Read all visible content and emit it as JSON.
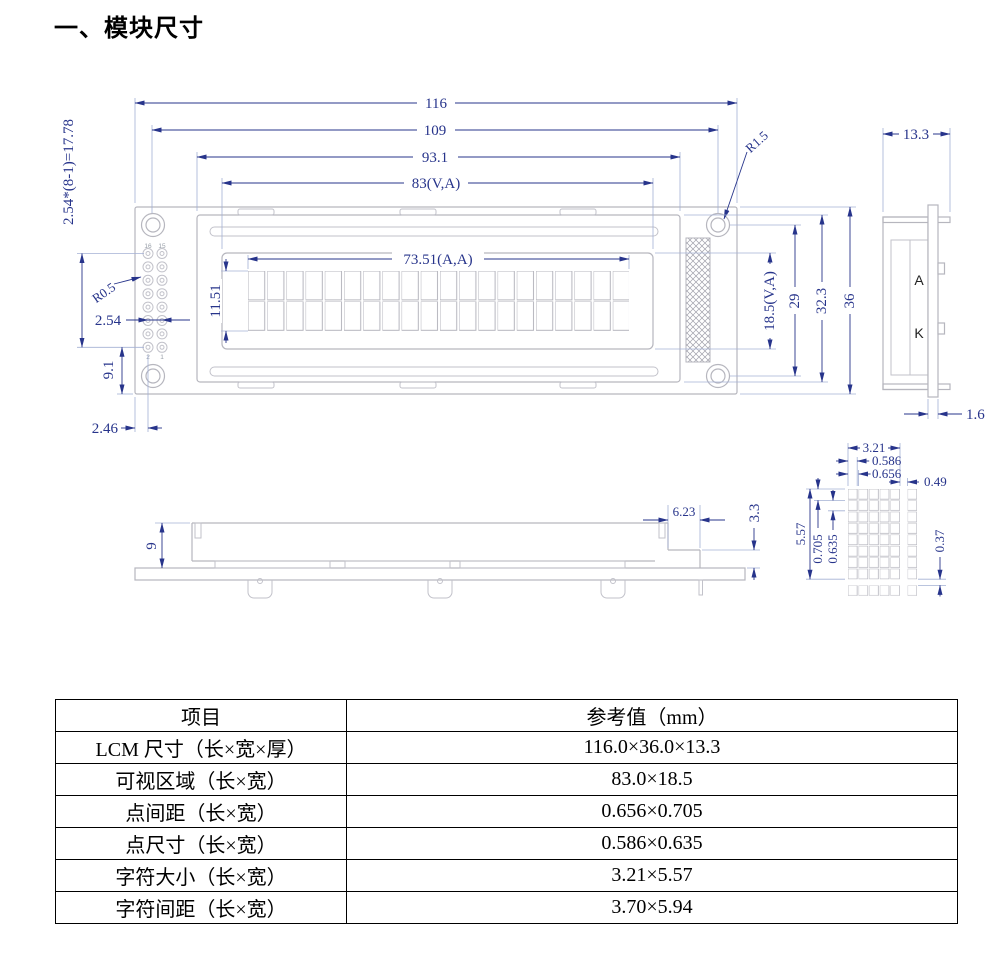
{
  "title": "一、模块尺寸",
  "colors": {
    "dimension": "#27348b",
    "outline": "#b6b6be",
    "extension": "#a4b0d4",
    "table_text": "#000000"
  },
  "front_view": {
    "dim_width_total": "116",
    "dim_width_holes": "109",
    "dim_width_bezel": "93.1",
    "dim_width_viewing": "83(V,A)",
    "dim_width_active": "73.51(A,A)",
    "dim_height_active": "11.51",
    "dim_pin_span": "2.54*(8-1)=17.78",
    "dim_pad_radius": "R0.5",
    "dim_pin_pitch": "2.54",
    "dim_pin_bottom": "9.1",
    "dim_pin_left": "2.46",
    "dim_hole_radius": "R1.5",
    "dim_height_viewing": "18.5(V,A)",
    "dim_height_holes": "29",
    "dim_height_bezel": "32.3",
    "dim_height_total": "36",
    "pin_label_16": "16",
    "pin_label_15": "15",
    "pin_label_2": "2",
    "pin_label_1": "1"
  },
  "side_view": {
    "dim_thickness": "13.3",
    "dim_pcb_thickness": "1.6",
    "label_anode": "A",
    "label_cathode": "K"
  },
  "bottom_view": {
    "dim_height": "9",
    "dim_tail_width": "6.23",
    "dim_tail_height": "3.3"
  },
  "dot_detail": {
    "dim_char_width": "3.21",
    "dim_dot_width": "0.586",
    "dim_dot_pitch_x": "0.656",
    "dim_char_gap_x": "0.49",
    "dim_char_height": "5.57",
    "dim_dot_pitch_y": "0.705",
    "dim_dot_height": "0.635",
    "dim_char_gap_y": "0.37"
  },
  "table": {
    "headers": [
      "项目",
      "参考值（mm）"
    ],
    "rows": [
      {
        "item": "LCM 尺寸（长×宽×厚）",
        "value": "116.0×36.0×13.3"
      },
      {
        "item": "可视区域（长×宽）",
        "value": "83.0×18.5"
      },
      {
        "item": "点间距（长×宽）",
        "value": "0.656×0.705"
      },
      {
        "item": "点尺寸（长×宽）",
        "value": "0.586×0.635"
      },
      {
        "item": "字符大小（长×宽）",
        "value": "3.21×5.57"
      },
      {
        "item": "字符间距（长×宽）",
        "value": "3.70×5.94"
      }
    ]
  }
}
